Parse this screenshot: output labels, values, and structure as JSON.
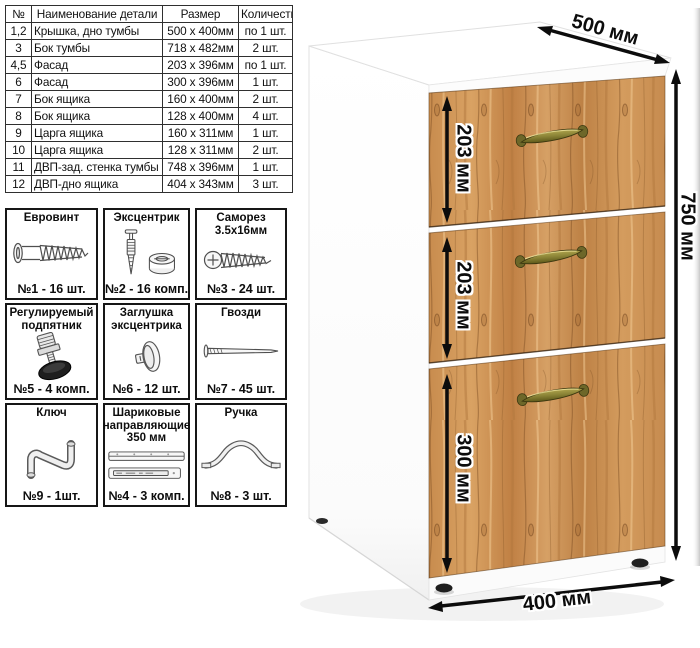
{
  "parts_table": {
    "headers": [
      "№",
      "Наименование детали",
      "Размер",
      "Количество"
    ],
    "rows": [
      {
        "num": "1,2",
        "name": "Крышка, дно тумбы",
        "size": "500 х 400мм",
        "qty": "по 1 шт."
      },
      {
        "num": "3",
        "name": "Бок тумбы",
        "size": "718 х 482мм",
        "qty": "2 шт."
      },
      {
        "num": "4,5",
        "name": "Фасад",
        "size": "203 х 396мм",
        "qty": "по 1 шт."
      },
      {
        "num": "6",
        "name": "Фасад",
        "size": "300 х 396мм",
        "qty": "1 шт."
      },
      {
        "num": "7",
        "name": "Бок ящика",
        "size": "160 х 400мм",
        "qty": "2 шт."
      },
      {
        "num": "8",
        "name": "Бок ящика",
        "size": "128 х 400мм",
        "qty": "4 шт."
      },
      {
        "num": "9",
        "name": "Царга ящика",
        "size": "160 х 311мм",
        "qty": "1 шт."
      },
      {
        "num": "10",
        "name": "Царга ящика",
        "size": "128 х 311мм",
        "qty": "2 шт."
      },
      {
        "num": "11",
        "name": "ДВП-зад. стенка тумбы",
        "size": "748 х 396мм",
        "qty": "1 шт."
      },
      {
        "num": "12",
        "name": "ДВП-дно ящика",
        "size": "404 х 343мм",
        "qty": "3 шт."
      }
    ]
  },
  "hardware": {
    "items": [
      {
        "title": "Евровинт",
        "count": "№1 - 16 шт.",
        "icon": "euroscrew-icon"
      },
      {
        "title": "Эксцентрик",
        "count": "№2 - 16 комп.",
        "icon": "cam-lock-icon"
      },
      {
        "title": "Саморез 3.5х16мм",
        "count": "№3 - 24 шт.",
        "icon": "self-tapping-screw-icon"
      },
      {
        "title": "Регулируемый подпятник",
        "count": "№5 - 4 комп.",
        "icon": "adjustable-foot-icon"
      },
      {
        "title": "Заглушка эксцентрика",
        "count": "№6 - 12 шт.",
        "icon": "cam-cover-icon"
      },
      {
        "title": "Гвозди",
        "count": "№7 - 45 шт.",
        "icon": "nail-icon"
      },
      {
        "title": "Ключ",
        "count": "№9 - 1шт.",
        "icon": "hex-key-icon"
      },
      {
        "title": "Шариковые направляющие 350 мм",
        "count": "№4 - 3 комп.",
        "icon": "drawer-slides-icon"
      },
      {
        "title": "Ручка",
        "count": "№8 - 3 шт.",
        "icon": "handle-icon"
      }
    ]
  },
  "dimensions": {
    "top_depth": "500 мм",
    "height": "750 мм",
    "bottom_width": "400 мм",
    "drawer1_height": "203 мм",
    "drawer2_height": "203 мм",
    "drawer3_height": "300 мм"
  },
  "colors": {
    "wood": "#cd9254",
    "wood_dark": "#9c6a34",
    "handle_brass": "#857d33",
    "dimension_text": "#0c0c0c"
  }
}
